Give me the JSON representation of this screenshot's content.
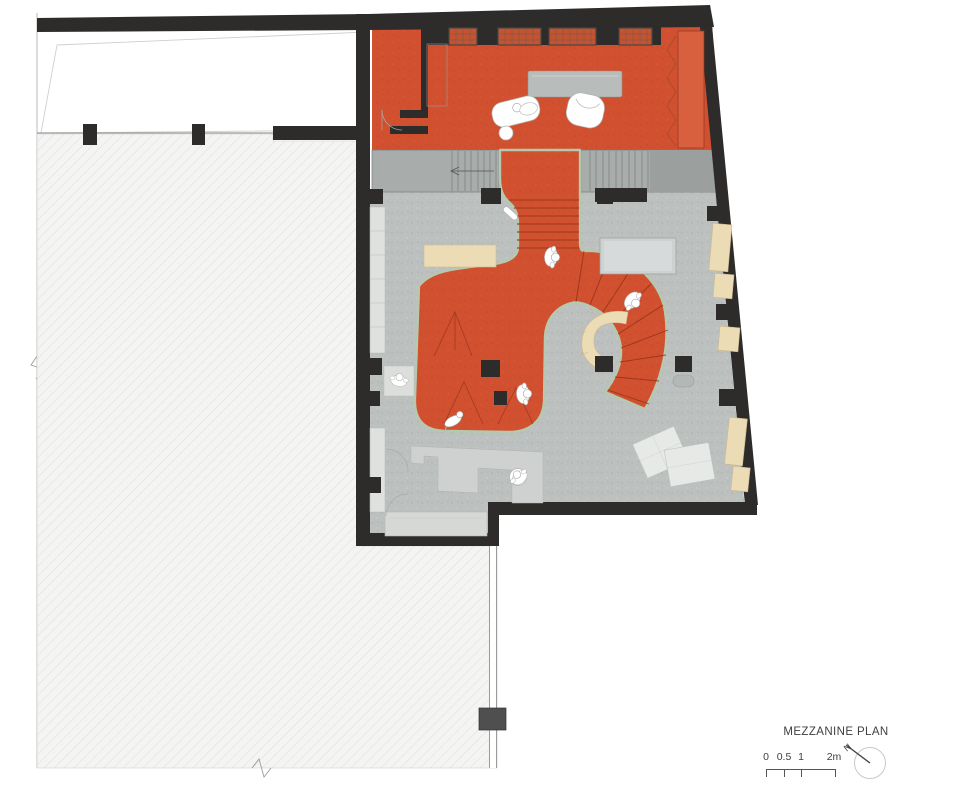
{
  "title_block": {
    "title": "MEZZANINE PLAN",
    "scale_labels": [
      "0",
      "0.5",
      "1",
      "2m"
    ],
    "north_label": "N"
  },
  "colors": {
    "wall": "#2e2c2b",
    "orange_floor": "#d0502f",
    "orange_dark_line": "#a93d22",
    "carpet_edge": "#b5c9ae",
    "floor_gray": "#bcc0bf",
    "stair_gray": "#a8acab",
    "landing_gray": "#9ba09f",
    "hatch_bg": "#f4f4f3",
    "hatch_line": "#dedede",
    "wood": "#ecdcb6",
    "wardrobe": "#d9603f",
    "text": "#3f3f3f"
  }
}
